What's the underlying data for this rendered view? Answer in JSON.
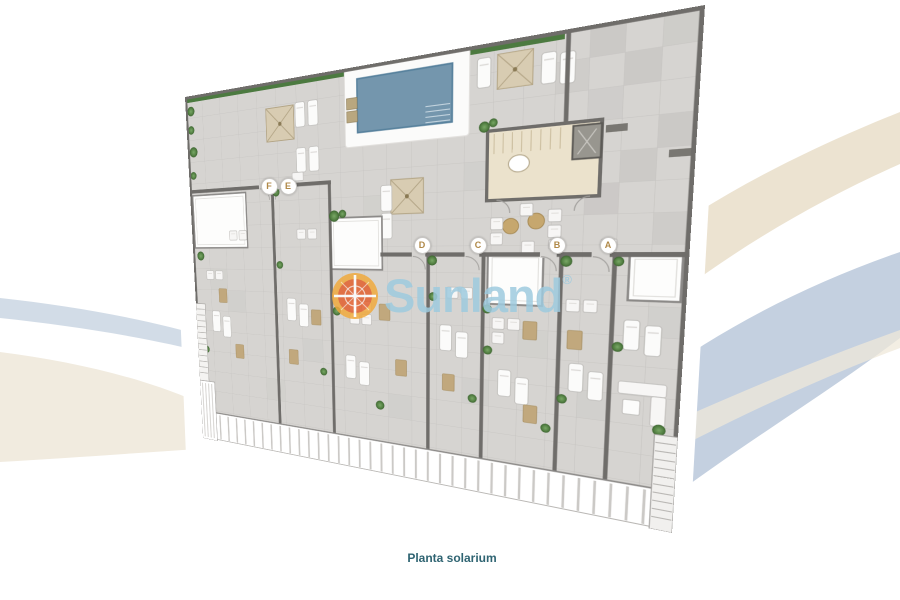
{
  "page": {
    "caption": "Planta solarium",
    "background": "#ffffff"
  },
  "watermark": {
    "brand": "Sunland",
    "registered": "®"
  },
  "plan": {
    "name": "Planta solarium",
    "unit_labels": [
      "F",
      "E",
      "D",
      "C",
      "B",
      "A"
    ],
    "features": [
      "swimming-pool",
      "stair-core",
      "elevator",
      "parasols",
      "sun-loungers",
      "hedge",
      "skylights",
      "railings"
    ]
  },
  "colors": {
    "pool": "#7496ad",
    "hedge": "#4c7a40",
    "caption": "#2f6472",
    "wm_blue": "#9ecbdf",
    "label_gold": "#b08948",
    "swoosh_beige": "#ece3d1",
    "swoosh_blue": "#c4d0e0",
    "wall": "#6f6d6a",
    "floor_tile": "#d6d4d1",
    "stair_core": "#ebe2cc",
    "umbrella": "#d8ccb2",
    "mat": "#c1a87d",
    "watermark_orange": "#e8742c"
  }
}
